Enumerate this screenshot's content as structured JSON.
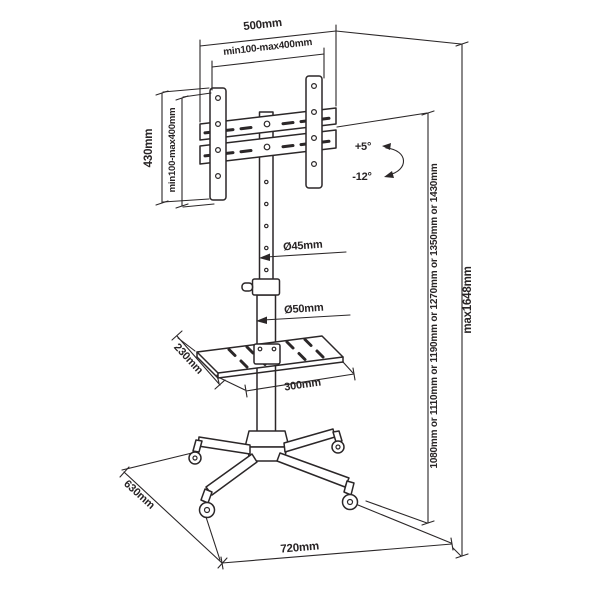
{
  "dimensions": {
    "bracket_width": "500mm",
    "vesa_width": "min100-max400mm",
    "bracket_height": "430mm",
    "vesa_height": "min100-max400mm",
    "tilt_up": "+5°",
    "tilt_down": "-12°",
    "upper_pole_diameter": "Ø45mm",
    "lower_pole_diameter": "Ø50mm",
    "shelf_depth": "230mm",
    "shelf_width": "300mm",
    "height_options": "1080mm or 1110mm or 1190mm or 1270mm or 1350mm or 1430mm",
    "max_height": "max1648mm",
    "base_depth": "630mm",
    "base_width": "720mm"
  },
  "colors": {
    "line": "#2b2728",
    "text": "#282425",
    "background": "#ffffff"
  }
}
